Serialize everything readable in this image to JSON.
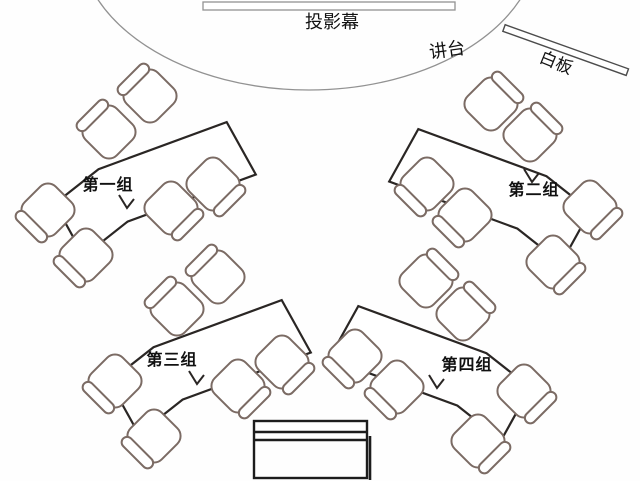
{
  "stage": {
    "screen_label": "投影幕",
    "podium_label": "讲台",
    "whiteboard_label": "白板"
  },
  "groups": [
    {
      "label": "第一组",
      "label_x": 108,
      "label_y": 190,
      "table": {
        "cx": 148,
        "cy": 176,
        "angle": -29,
        "mirror": false
      },
      "seam": {
        "x": 127,
        "y": 204
      },
      "chairs": [
        [
          150,
          96,
          -45
        ],
        [
          109,
          132,
          -45
        ],
        [
          48,
          210,
          -135
        ],
        [
          213,
          184,
          135
        ],
        [
          171,
          208,
          135
        ],
        [
          86,
          255,
          -135
        ]
      ]
    },
    {
      "label": "第二组",
      "label_x": 534,
      "label_y": 195,
      "table": {
        "cx": 497,
        "cy": 183,
        "angle": 29,
        "mirror": true
      },
      "seam": {
        "x": 532,
        "y": 178
      },
      "chairs": [
        [
          491,
          104,
          45
        ],
        [
          530,
          135,
          45
        ],
        [
          590,
          207,
          135
        ],
        [
          427,
          184,
          -135
        ],
        [
          465,
          215,
          -135
        ],
        [
          553,
          262,
          135
        ]
      ]
    },
    {
      "label": "第三组",
      "label_x": 172,
      "label_y": 365,
      "table": {
        "cx": 203,
        "cy": 354,
        "angle": -29,
        "mirror": false
      },
      "seam": {
        "x": 197,
        "y": 380
      },
      "chairs": [
        [
          218,
          277,
          -45
        ],
        [
          177,
          309,
          -45
        ],
        [
          115,
          381,
          -135
        ],
        [
          282,
          362,
          135
        ],
        [
          238,
          386,
          135
        ],
        [
          154,
          436,
          -135
        ]
      ]
    },
    {
      "label": "第四组",
      "label_x": 467,
      "label_y": 370,
      "table": {
        "cx": 437,
        "cy": 360,
        "angle": 29,
        "mirror": true
      },
      "seam": {
        "x": 437,
        "y": 384
      },
      "chairs": [
        [
          426,
          281,
          45
        ],
        [
          463,
          314,
          45
        ],
        [
          355,
          356,
          -135
        ],
        [
          397,
          387,
          -135
        ],
        [
          524,
          391,
          135
        ],
        [
          478,
          441,
          135
        ]
      ]
    }
  ],
  "fixtures": {
    "stage_arc": {
      "cx": 309,
      "cy": -60,
      "rx": 230,
      "ry": 150
    },
    "projection_screen": {
      "x": 203,
      "y": 2,
      "w": 252,
      "h": 8
    },
    "whiteboard": {
      "x": 504,
      "y": 28,
      "length": 131,
      "thickness": 7,
      "angle": 19.7
    },
    "teacher_desk": {
      "x": 254,
      "y": 421,
      "w": 113,
      "h": 57,
      "band_y1": 432,
      "band_y2": 440
    }
  },
  "label_positions": {
    "screen": {
      "x": 332,
      "y": 28
    },
    "podium": {
      "x": 448,
      "y": 56,
      "rotate": -8
    },
    "whiteboard": {
      "x": 554,
      "y": 68,
      "rotate": 22
    }
  },
  "colors": {
    "table_stroke": "#2a2624",
    "chair_stroke": "#7b6b64",
    "stage_line": "#929292",
    "desk_stroke": "#1c1c1c",
    "text": "#111111",
    "background": "#fefefe"
  }
}
